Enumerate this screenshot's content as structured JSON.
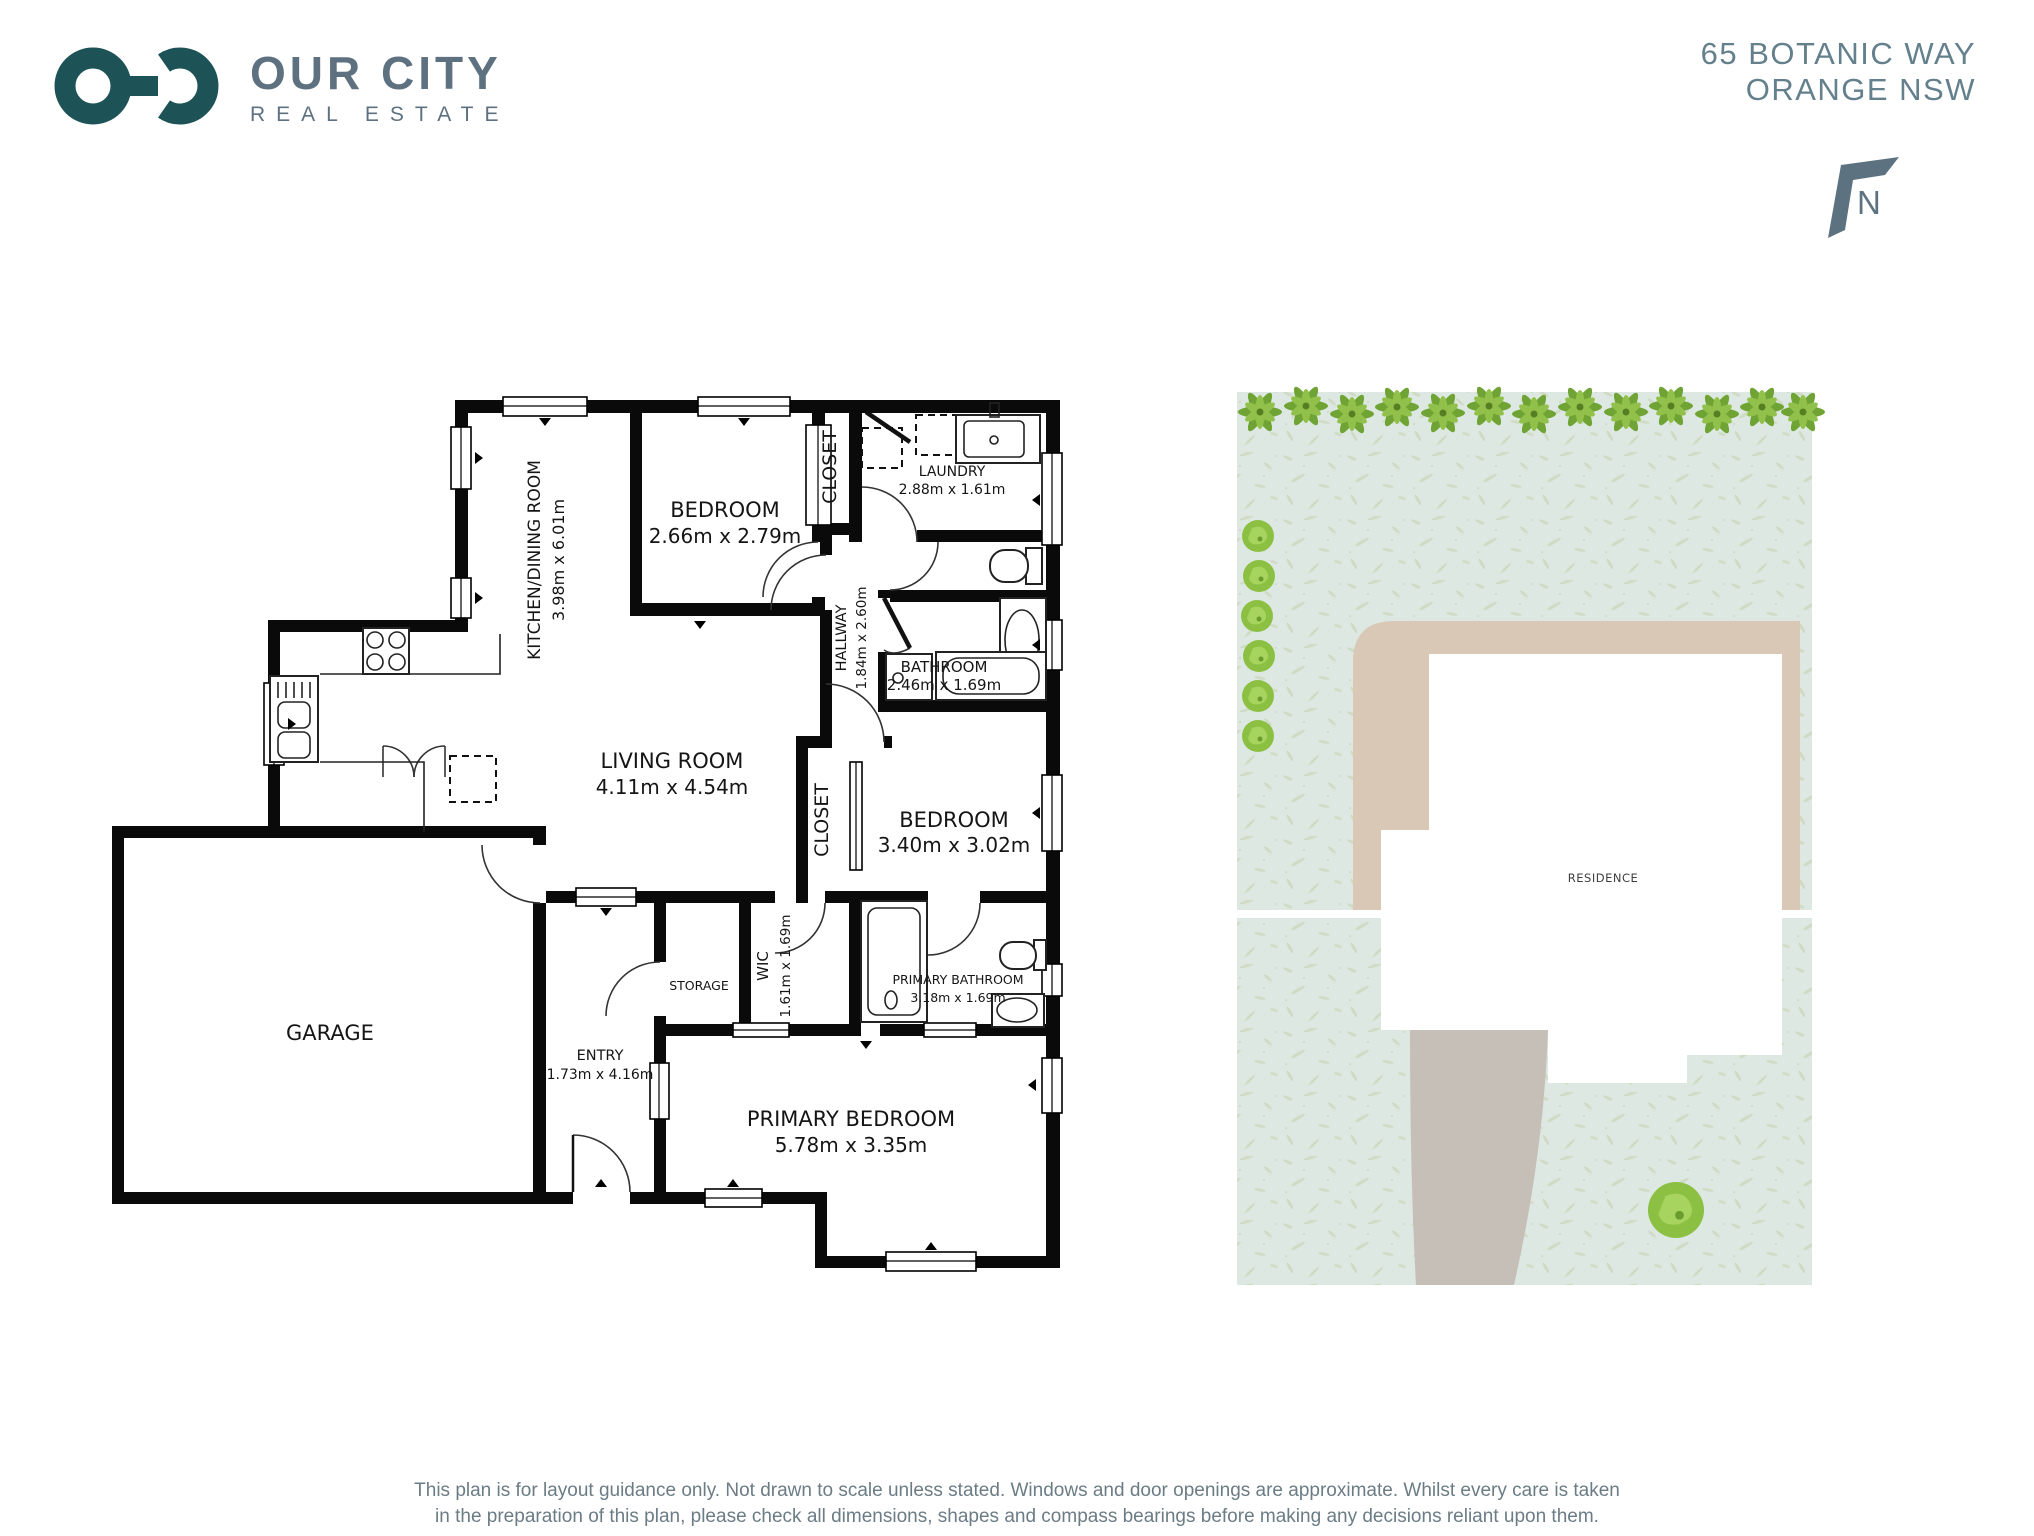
{
  "brand": {
    "name": "OUR CITY",
    "subtitle": "REAL ESTATE"
  },
  "address": {
    "line1": "65 BOTANIC WAY",
    "line2": "ORANGE NSW"
  },
  "compass": {
    "label": "N"
  },
  "floor_plan": {
    "rooms": {
      "kitchen": {
        "name": "KITCHEN/DINING ROOM",
        "dims": "3.98m x 6.01m"
      },
      "bedroom1": {
        "name": "BEDROOM",
        "dims": "2.66m x 2.79m"
      },
      "closet1": {
        "name": "CLOSET"
      },
      "laundry": {
        "name": "LAUNDRY",
        "dims": "2.88m x 1.61m"
      },
      "hallway": {
        "name": "HALLWAY",
        "dims": "1.84m x 2.60m"
      },
      "bathroom": {
        "name": "BATHROOM",
        "dims": "2.46m x 1.69m"
      },
      "living": {
        "name": "LIVING ROOM",
        "dims": "4.11m x 4.54m"
      },
      "closet2": {
        "name": "CLOSET"
      },
      "bedroom2": {
        "name": "BEDROOM",
        "dims": "3.40m x 3.02m"
      },
      "garage": {
        "name": "GARAGE"
      },
      "storage": {
        "name": "STORAGE"
      },
      "wic": {
        "name": "WIC",
        "dims": "1.61m x 1.69m"
      },
      "primary_bathroom": {
        "name": "PRIMARY BATHROOM",
        "dims": "3.18m x 1.69m"
      },
      "entry": {
        "name": "ENTRY",
        "dims": "1.73m x 4.16m"
      },
      "primary_bedroom": {
        "name": "PRIMARY BEDROOM",
        "dims": "5.78m x 3.35m"
      }
    }
  },
  "site_plan": {
    "residence_label": "RESIDENCE"
  },
  "footer": {
    "line1": "This plan is for layout guidance only. Not drawn to scale unless stated. Windows and door openings are approximate. Whilst every care is taken",
    "line2": "in the preparation of this plan, please check all dimensions, shapes and compass bearings before making any decisions reliant upon them."
  },
  "colors": {
    "wall_black": "#0a0a0a",
    "brand_teal": "#1d5356",
    "brand_gray": "#5e7180",
    "address_gray": "#64808d",
    "grass": "#dde8e2",
    "grass_speckle": "#cdd9bf",
    "path_tan": "#d9c8b6",
    "driveway_gray": "#c5bfb7",
    "plant_green_dark": "#6fa434",
    "plant_green_light": "#92c14b",
    "bush_green": "#8cc043"
  }
}
